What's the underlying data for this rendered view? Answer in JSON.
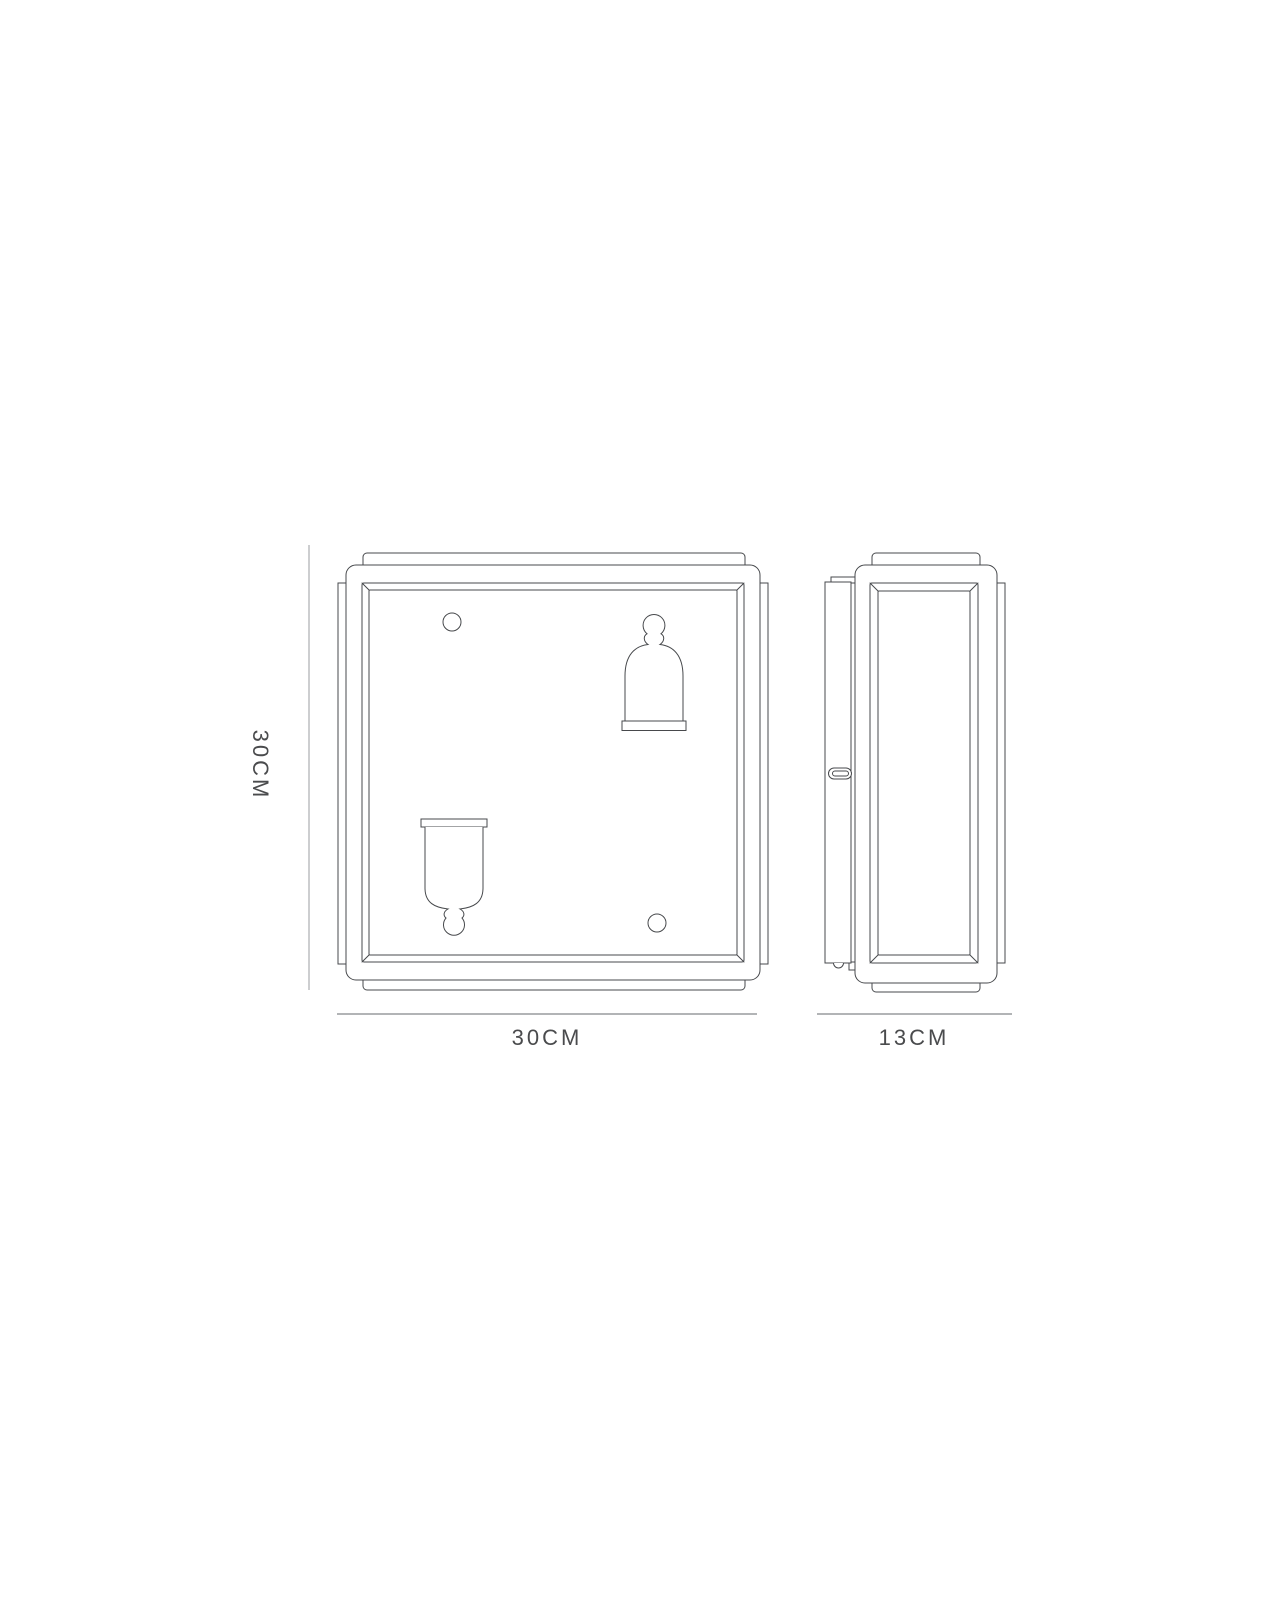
{
  "diagram": {
    "type": "technical-dimension-drawing",
    "dimensions": {
      "height": "30CM",
      "width": "30CM",
      "depth": "13CM"
    },
    "colors": {
      "line": "#47494c",
      "dimension_line": "#b2b4b6",
      "label": "#4a4b4d",
      "background": "#ffffff"
    }
  }
}
